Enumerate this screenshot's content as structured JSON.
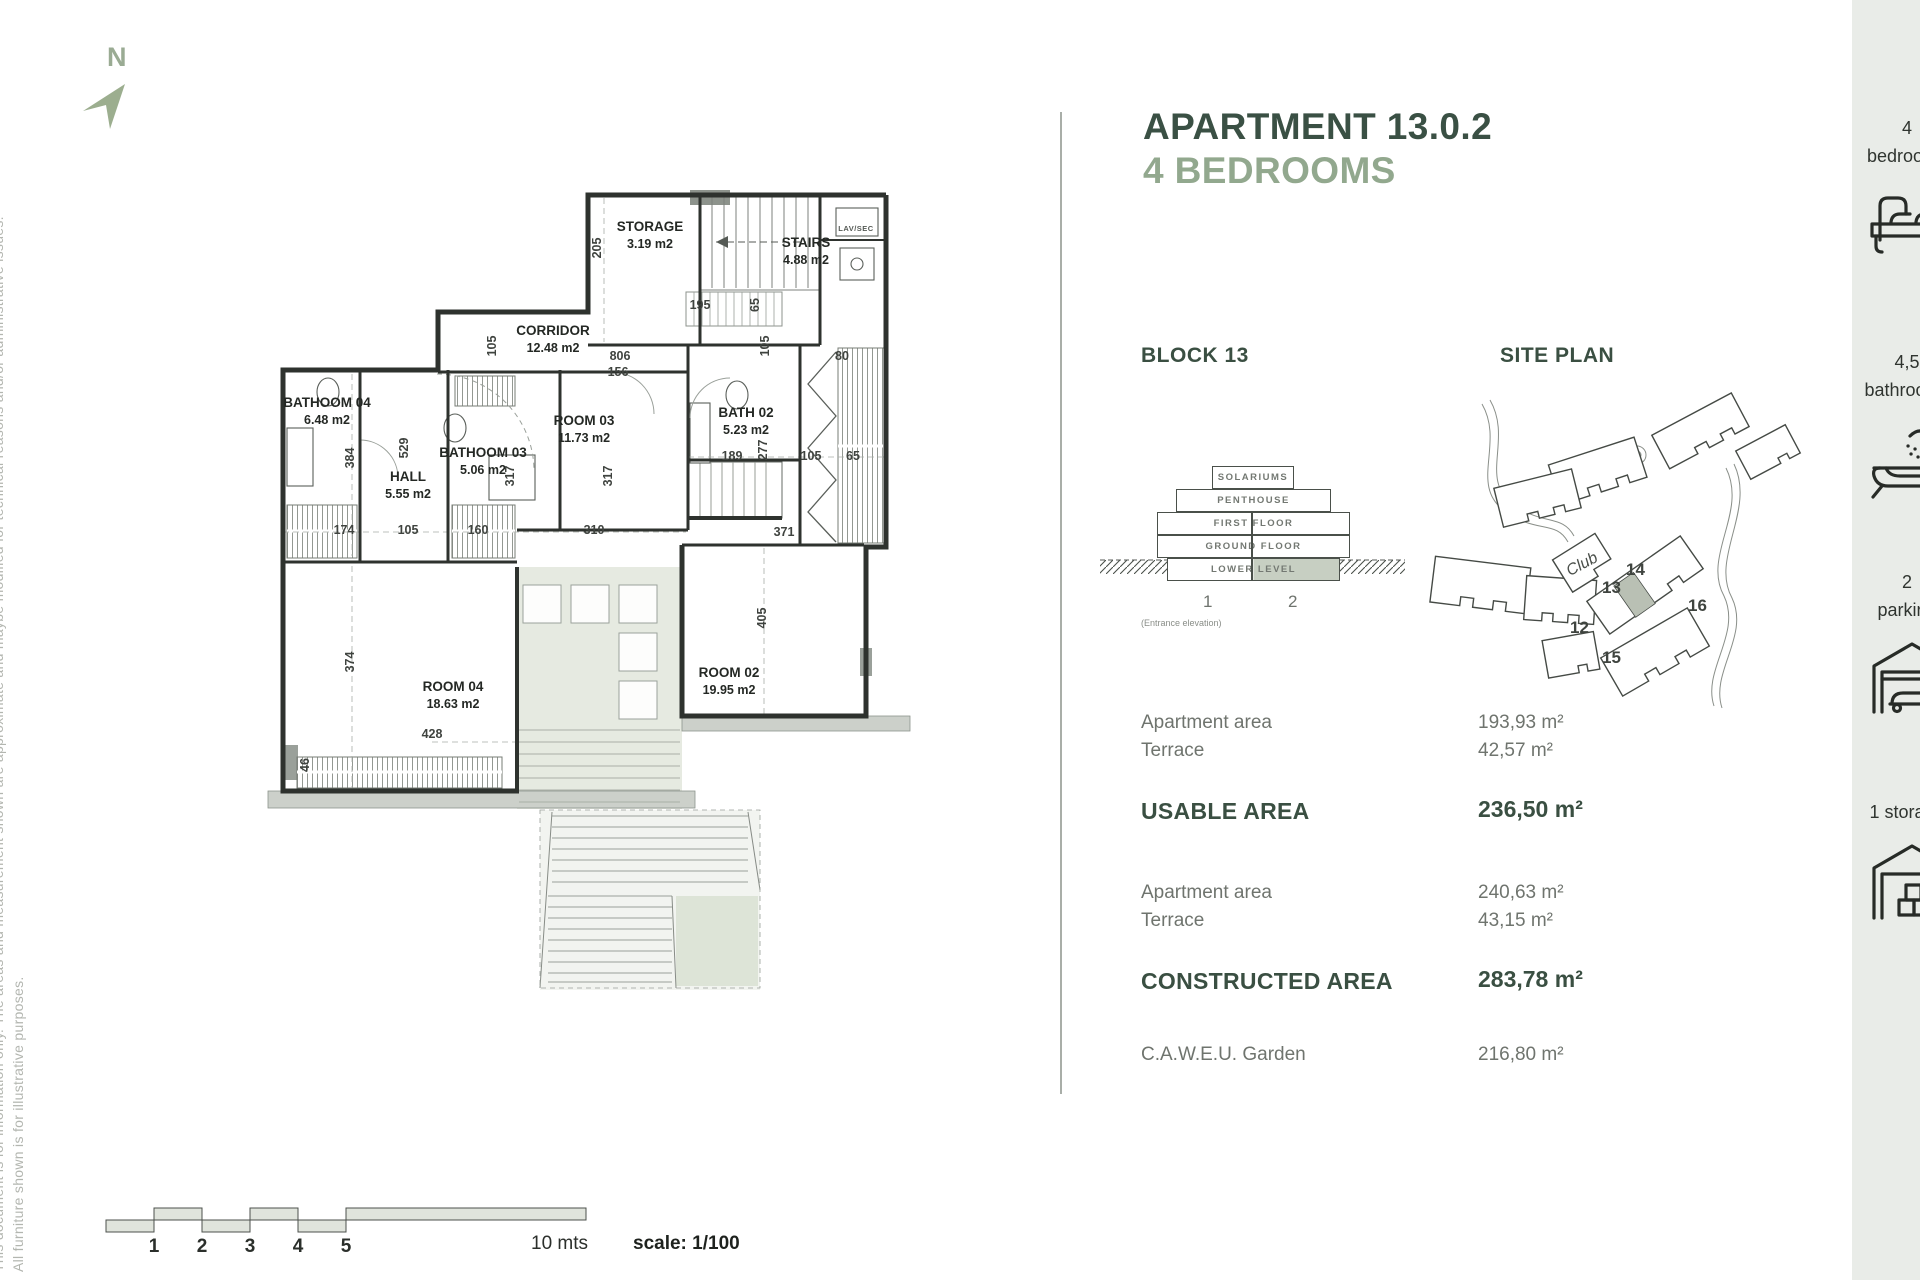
{
  "north": {
    "label": "N"
  },
  "disclaimer": {
    "line1": "This document is for information only. The areas and measurement shown are approximate and maybe modified for technical reasons and/or administrative issues.",
    "line2": "All furniture shown is for illustrative purposes."
  },
  "floor_plan": {
    "rooms": [
      {
        "name": "STORAGE",
        "area": "3.19 m2"
      },
      {
        "name": "STAIRS",
        "area": "4.88 m2"
      },
      {
        "name": "CORRIDOR",
        "area": "12.48 m2"
      },
      {
        "name": "BATHOOM 04",
        "area": "6.48 m2"
      },
      {
        "name": "HALL",
        "area": "5.55 m2"
      },
      {
        "name": "BATHOOM 03",
        "area": "5.06 m2"
      },
      {
        "name": "ROOM 03",
        "area": "11.73 m2"
      },
      {
        "name": "BATH 02",
        "area": "5.23 m2"
      },
      {
        "name": "ROOM 04",
        "area": "18.63 m2"
      },
      {
        "name": "ROOM 02",
        "area": "19.95 m2"
      }
    ],
    "small_labels": {
      "lav": "LAV/SEC"
    },
    "dims": [
      "205",
      "156",
      "195",
      "65",
      "806",
      "105",
      "105",
      "80",
      "384",
      "529",
      "317",
      "317",
      "189",
      "277",
      "105",
      "65",
      "174",
      "105",
      "160",
      "310",
      "371",
      "374",
      "405",
      "428",
      "46"
    ]
  },
  "scale_bar": {
    "ticks": [
      "1",
      "2",
      "3",
      "4",
      "5"
    ],
    "end_label": "10 mts",
    "scale_label": "scale: 1/100"
  },
  "panel": {
    "title_line1": "APARTMENT 13.0.2",
    "title_line2": "4 BEDROOMS",
    "block_heading": "BLOCK 13",
    "site_heading": "SITE PLAN",
    "elevation": {
      "levels": [
        "SOLARIUMS",
        "PENTHOUSE",
        "FIRST FLOOR",
        "GROUND FLOOR",
        "LOWER LEVEL"
      ],
      "unit1": "1",
      "unit2": "2",
      "caption": "(Entrance elevation)"
    },
    "site_plan": {
      "club": "Club",
      "n12": "12",
      "n13": "13",
      "n14": "14",
      "n15": "15",
      "n16": "16"
    },
    "areas": {
      "row1_label": "Apartment area",
      "row1_value": "193,93 m²",
      "row2_label": "Terrace",
      "row2_value": "42,57 m²",
      "usable_label": "USABLE AREA",
      "usable_value": "236,50 m²",
      "row3_label": "Apartment area",
      "row3_value": "240,63 m²",
      "row4_label": "Terrace",
      "row4_value": "43,15 m²",
      "constructed_label": "CONSTRUCTED AREA",
      "constructed_value": "283,78 m²",
      "garden_label": "C.A.W.E.U. Garden",
      "garden_value": "216,80 m²"
    }
  },
  "sidebar": {
    "items": [
      {
        "count": "4",
        "label": "bedrooms"
      },
      {
        "count": "4,5",
        "label": "bathrooms"
      },
      {
        "count": "2",
        "label": "parking"
      },
      {
        "count": "1 storage",
        "label": ""
      }
    ]
  },
  "colors": {
    "accent_dark": "#3a5044",
    "accent_sage": "#92a88e",
    "sidebar_bg": "#e9ece8",
    "plan_green": "#e6eae1"
  }
}
